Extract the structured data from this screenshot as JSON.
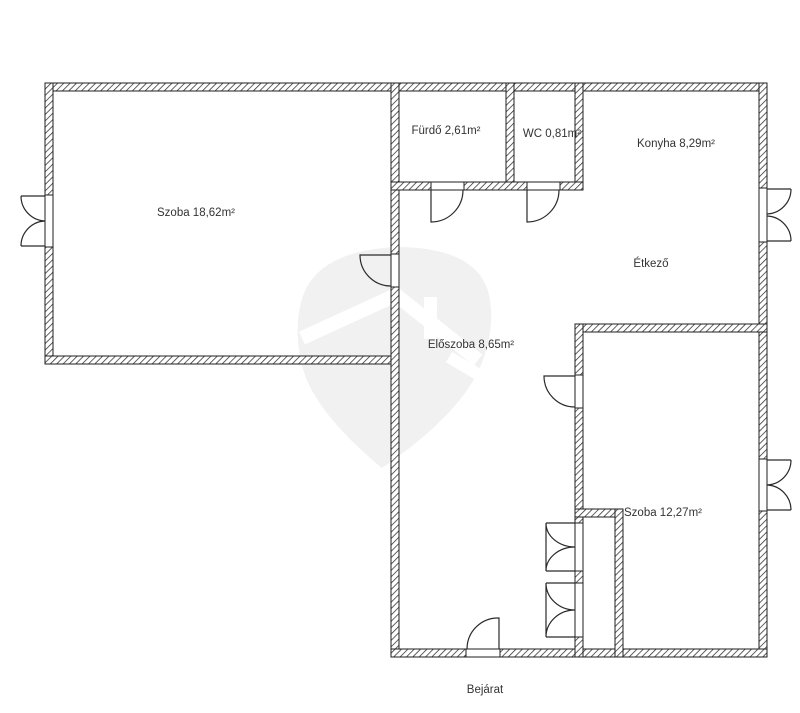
{
  "document": {
    "type": "apartment-floor-plan"
  },
  "colors": {
    "background": "#ffffff",
    "wall_line": "#1f1f1f",
    "label_text": "#333333",
    "watermark_fill": "#f1f1f1"
  },
  "rooms": [
    {
      "name": "szoba-1",
      "label": "Szoba 18,62m²"
    },
    {
      "name": "furdo",
      "label": "Fürdő 2,61m²"
    },
    {
      "name": "wc",
      "label": "WC 0,81m²"
    },
    {
      "name": "konyha",
      "label": "Konyha 8,29m²"
    },
    {
      "name": "etkezo",
      "label": "Étkező"
    },
    {
      "name": "eloszoba",
      "label": "Előszoba 8,65m²"
    },
    {
      "name": "szoba-2",
      "label": "Szoba 12,27m²"
    }
  ],
  "entrance": {
    "label": "Bejárat"
  },
  "watermark": {
    "icon": "house-location-pin-watermark"
  }
}
